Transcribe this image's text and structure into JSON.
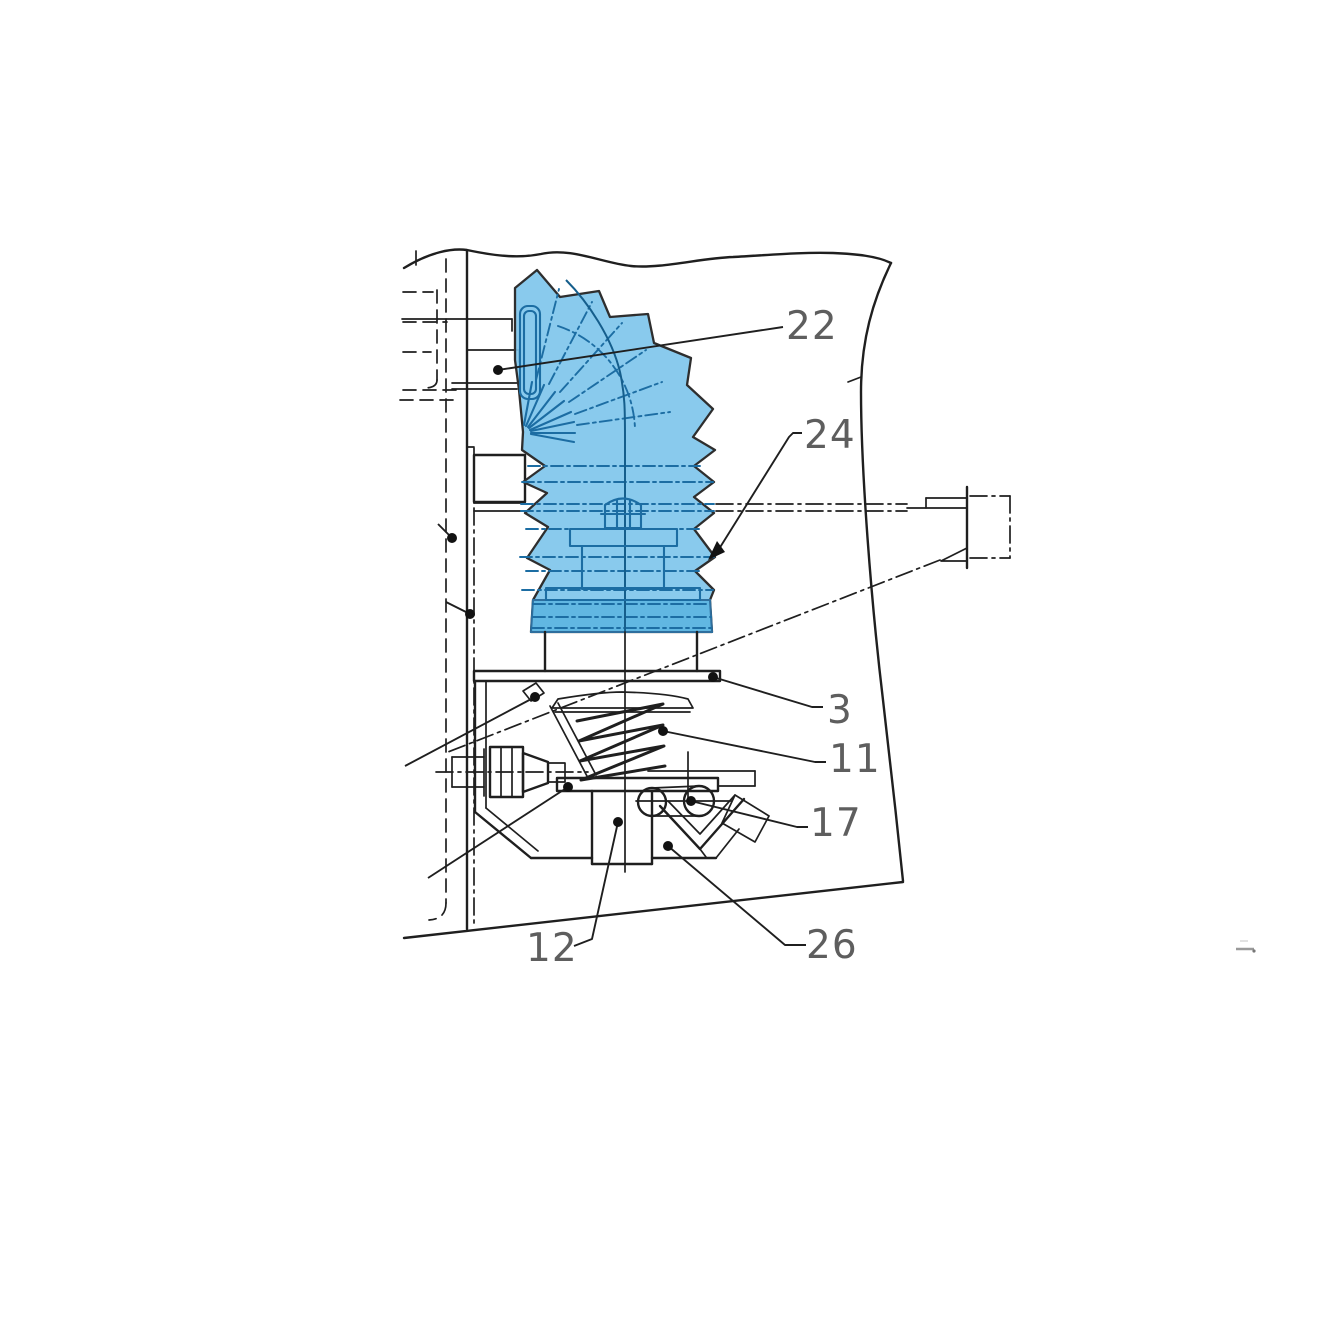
{
  "diagram": {
    "type": "technical-parts-drawing",
    "subject": "Sectional view of a control lever with flexible bellows boot mounted on a console panel; numbered part callouts",
    "colors": {
      "background": "#ffffff",
      "line": "#1f1f1f",
      "label": "#5e5e5e",
      "boot_fill": "#7fc6ec",
      "boot_band_fill": "#5fb5e2",
      "boot_line": "#1c6da3"
    },
    "callouts": [
      {
        "label": "22"
      },
      {
        "label": "24"
      },
      {
        "label": "3"
      },
      {
        "label": "11"
      },
      {
        "label": "17"
      },
      {
        "label": "12"
      },
      {
        "label": "26"
      }
    ]
  }
}
